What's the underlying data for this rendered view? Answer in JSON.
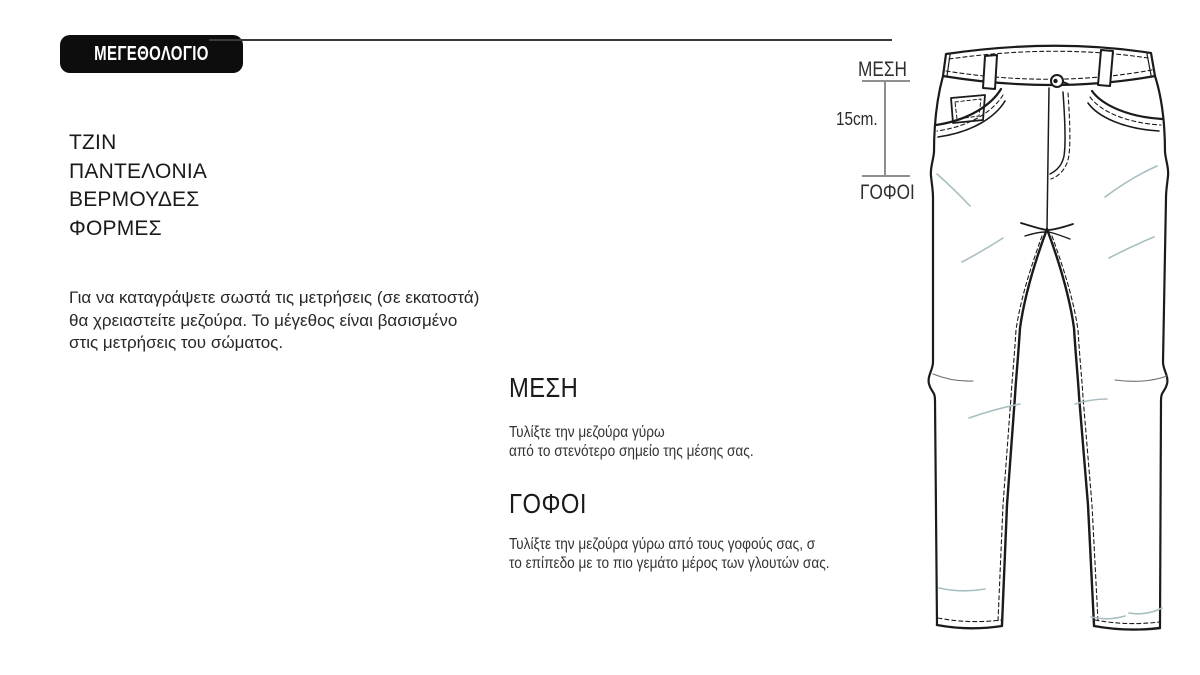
{
  "badge": {
    "label": "ΜΕΓΕΘΟΛΟΓΙΟ"
  },
  "categories": [
    "ΤΖΙΝ",
    "ΠΑΝΤΕΛΟΝΙΑ",
    "ΒΕΡΜΟΥΔΕΣ",
    "ΦΟΡΜΕΣ"
  ],
  "intro": {
    "lines": [
      "Για να καταγράψετε σωστά τις μετρήσεις (σε εκατοστά)",
      "θα χρειαστείτε μεζούρα. Το μέγεθος είναι βασισμένο",
      "στις μετρήσεις του σώματος."
    ]
  },
  "sections": {
    "waist": {
      "heading": "ΜΕΣΗ",
      "lines": [
        "Τυλίξτε την μεζούρα γύρω",
        "από το στενότερο σημείο της μέσης σας."
      ]
    },
    "hips": {
      "heading": "ΓΟΦΟΙ",
      "lines": [
        "Τυλίξτε την μεζούρα γύρω από τους γοφούς σας, σ",
        "το επίπεδο με το πιο γεμάτο μέρος των γλουτών σας."
      ]
    }
  },
  "diagram": {
    "waist_label": "ΜΕΣΗ",
    "distance_label": "15cm.",
    "hips_label": "ΓΟΦΟΙ",
    "illustration": "jeans-front-technical-sketch"
  },
  "colors": {
    "badge_bg": "#0d0d0d",
    "badge_text": "#ffffff",
    "text": "#1f1f1f",
    "divider": "#3a3a3a",
    "bracket_line": "#8e8e8e",
    "sketch_outline": "#1b1b1b",
    "sketch_wrinkle": "#a9bec0"
  }
}
